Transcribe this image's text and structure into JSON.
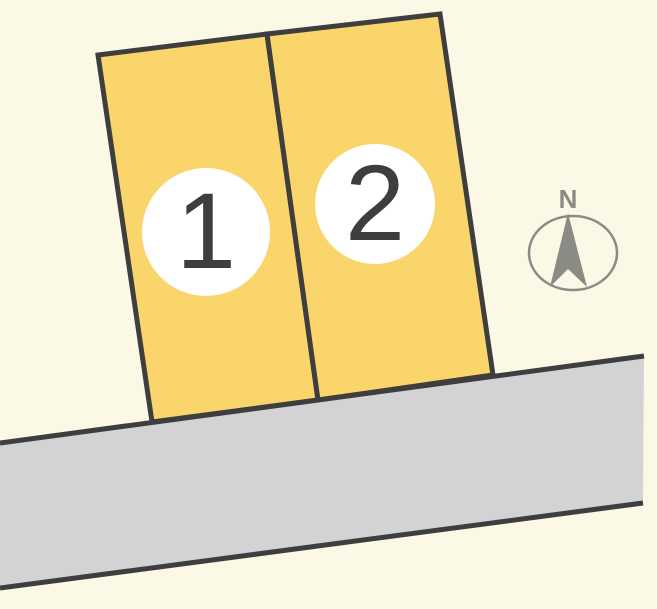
{
  "colors": {
    "background": "#FCF8E6",
    "parcel_fill": "#F9D56C",
    "outline": "#3E3E3E",
    "road_fill": "#D3D3D5",
    "badge_fill": "#FFFFFF",
    "number_color": "#3E3E40",
    "compass_gray": "#8B8B85"
  },
  "parcels": [
    {
      "label": "1"
    },
    {
      "label": "2"
    }
  ],
  "compass": {
    "label": "N"
  }
}
